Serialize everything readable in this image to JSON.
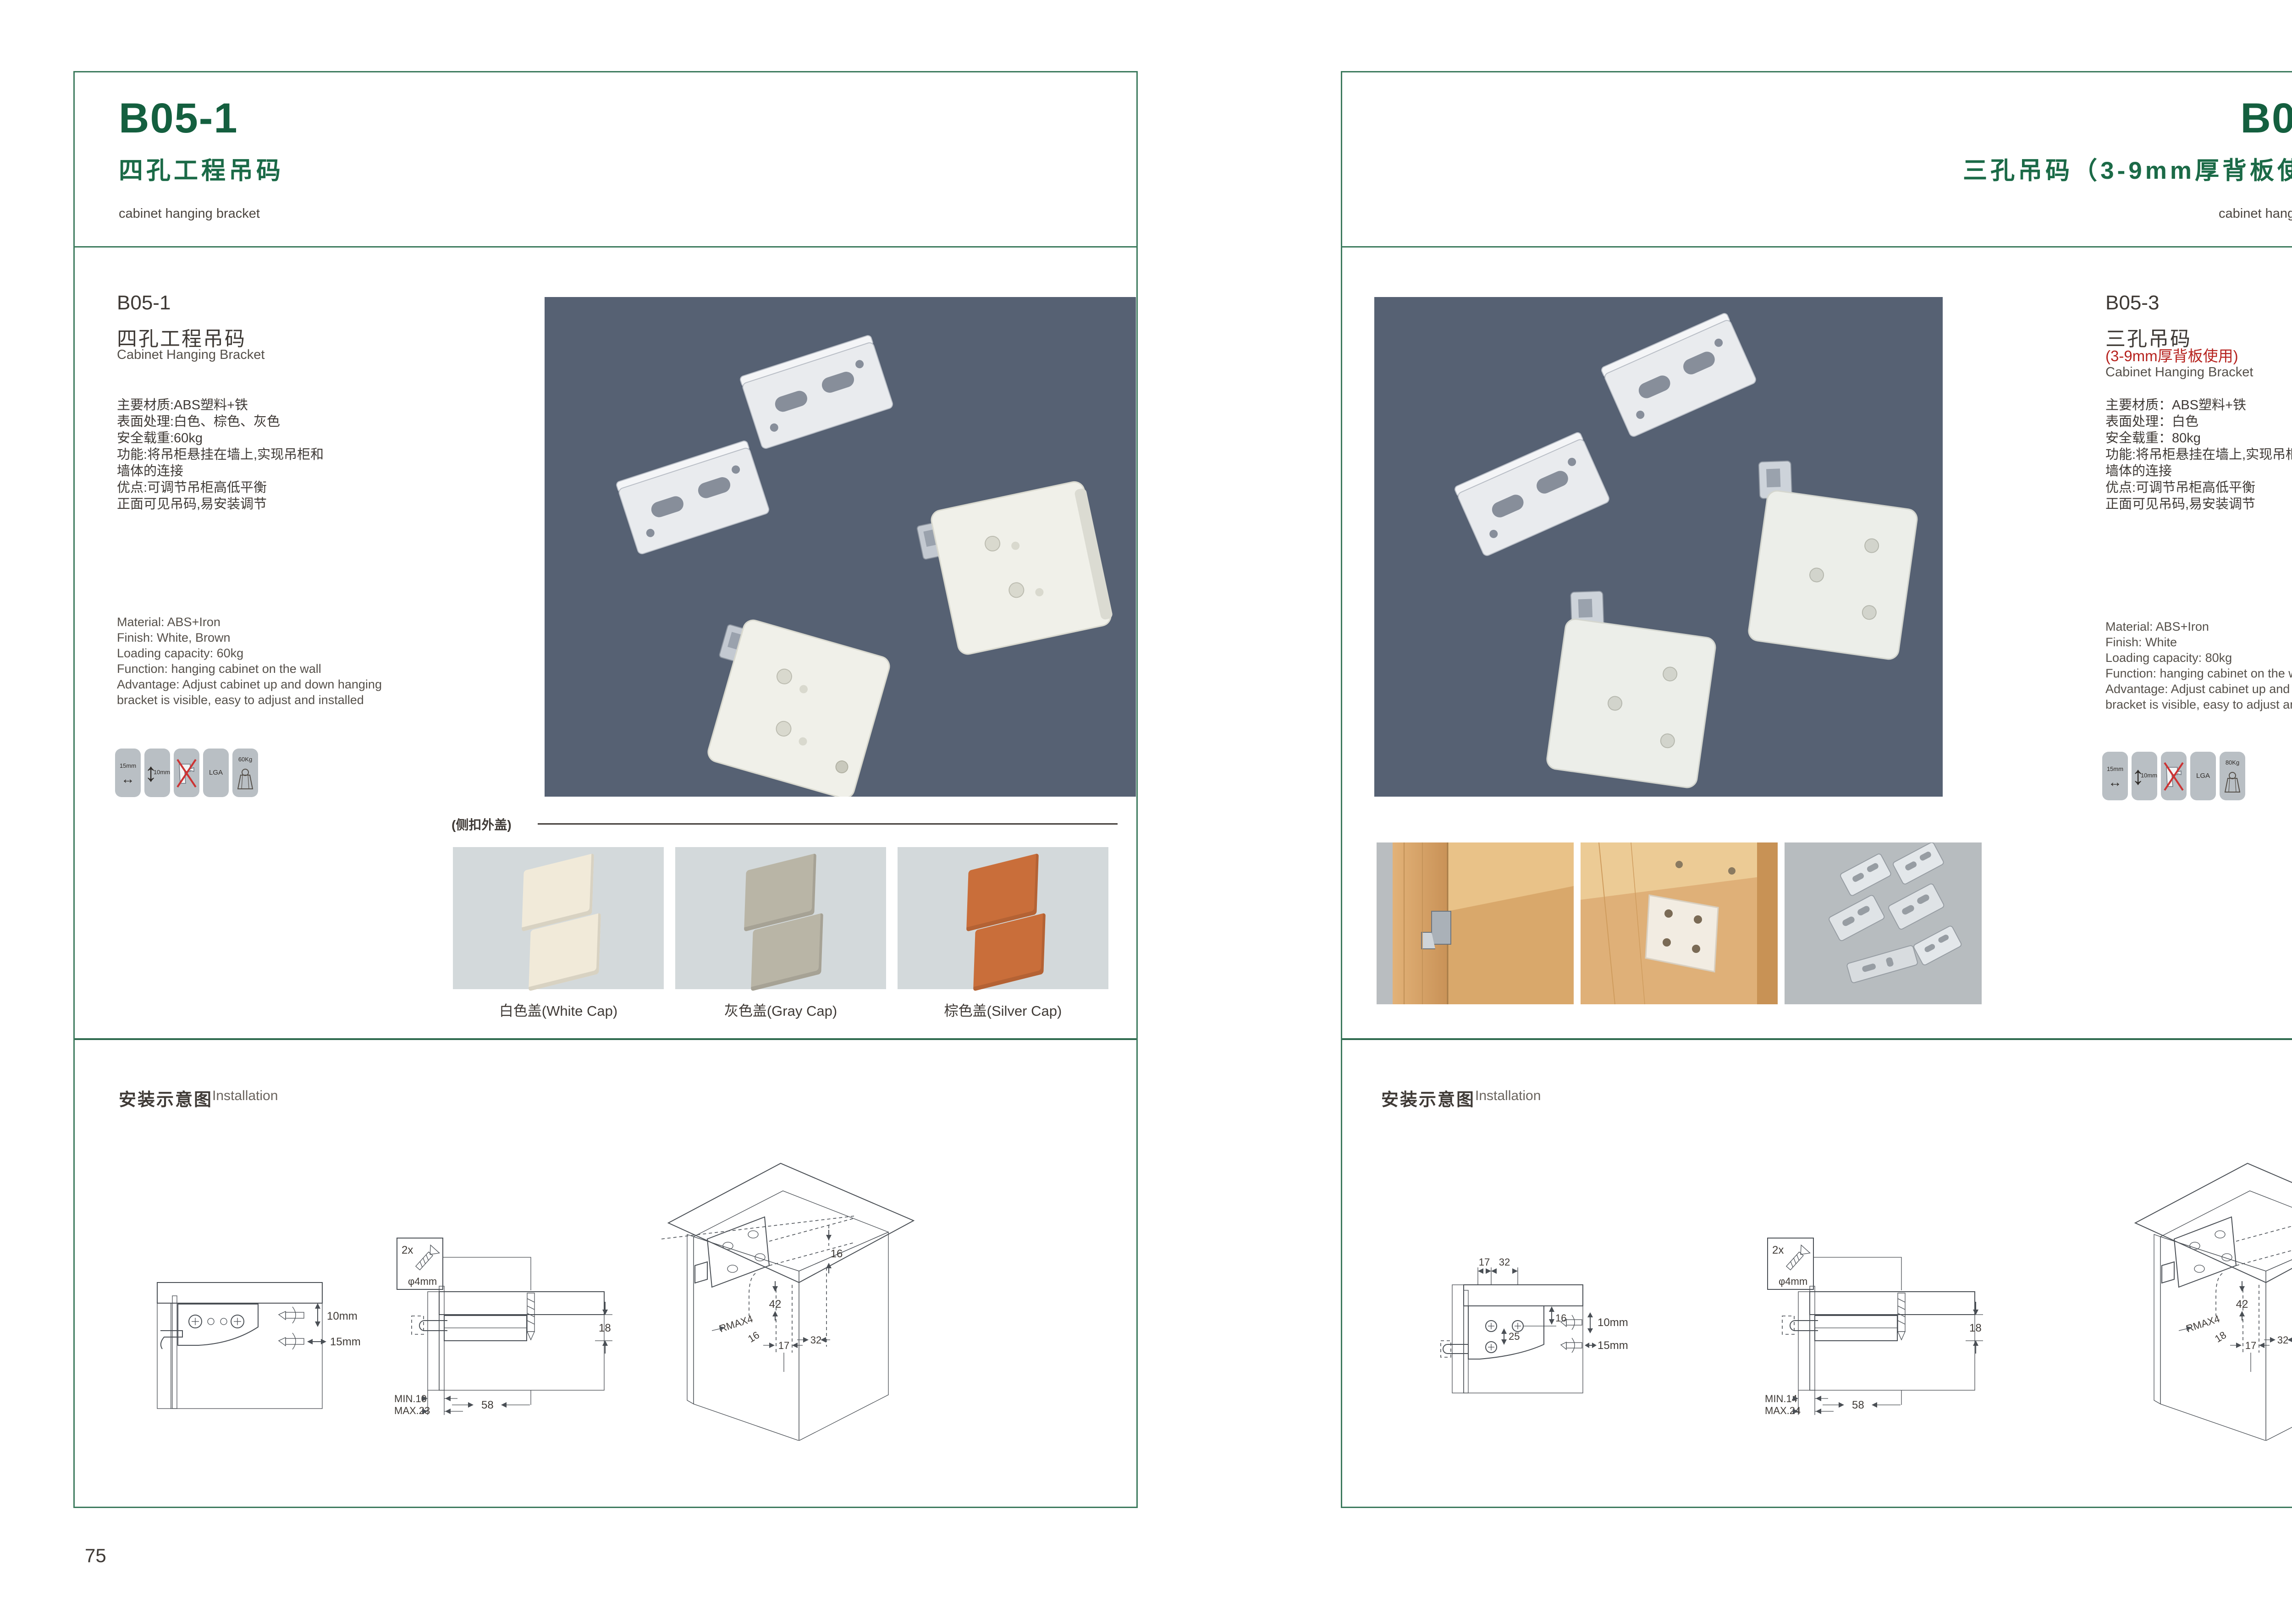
{
  "colors": {
    "frame_green": "#3c7a5d",
    "heading_green": "#145f3f",
    "accent_red": "#b6231f",
    "photo_background": "#566173",
    "cap_white": "#f1ead9",
    "cap_gray": "#b9b5a6",
    "cap_orange": "#c96e3a"
  },
  "page_left": {
    "header": {
      "code": "B05-1",
      "title_cn": "四孔工程吊码",
      "title_en": "cabinet hanging bracket"
    },
    "product": {
      "code": "B05-1",
      "name_cn": "四孔工程吊码",
      "name_en": "Cabinet Hanging Bracket",
      "specs_cn": [
        "主要材质:ABS塑料+铁",
        "表面处理:白色、棕色、灰色",
        "安全载重:60kg",
        "功能:将吊柜悬挂在墙上,实现吊柜和",
        "墙体的连接",
        "优点:可调节吊柜高低平衡",
        "正面可见吊码,易安装调节"
      ],
      "specs_en": [
        "Material: ABS+Iron",
        "Finish: White, Brown",
        "Loading capacity: 60kg",
        "Function: hanging cabinet on the wall",
        "Advantage: Adjust cabinet up and down hanging",
        "bracket is visible, easy to adjust and installed"
      ]
    },
    "icons": {
      "width_label": "15mm",
      "height_label": "10mm",
      "cert_label": "LGA",
      "load_label": "60Kg"
    },
    "caps": {
      "label": "(侧扣外盖)",
      "items": [
        {
          "caption": "白色盖(White Cap)",
          "color": "#f1ead9"
        },
        {
          "caption": "灰色盖(Gray Cap)",
          "color": "#b9b5a6"
        },
        {
          "caption": "棕色盖(Silver Cap)",
          "color": "#c96e3a"
        }
      ]
    },
    "installation": {
      "title_cn": "安装示意图",
      "title_en": "Installation",
      "d1": {
        "dim_v": "10mm",
        "dim_h": "15mm"
      },
      "d2": {
        "qty": "2x",
        "dia": "φ4mm",
        "h": "18",
        "min": "MIN.10",
        "max": "MAX.23",
        "depth": "58"
      },
      "d3": {
        "t": "16",
        "mid": "42",
        "r": "RMAX4",
        "b1": "16",
        "b2": "17",
        "b3": "32"
      }
    },
    "page_number": "75"
  },
  "page_right": {
    "header": {
      "code": "B05-3",
      "title_cn": "三孔吊码（3-9mm厚背板使用）",
      "title_en": "cabinet hanging bracket"
    },
    "product": {
      "code": "B05-3",
      "name_cn": "三孔吊码",
      "name_sub": "(3-9mm厚背板使用)",
      "name_en": "Cabinet Hanging Bracket",
      "specs_cn": [
        "主要材质：ABS塑料+铁",
        "表面处理：白色",
        "安全载重：80kg",
        "功能:将吊柜悬挂在墙上,实现吊柜和",
        "墙体的连接",
        "优点:可调节吊柜高低平衡",
        "正面可见吊码,易安装调节"
      ],
      "specs_en": [
        "Material: ABS+Iron",
        "Finish: White",
        "Loading capacity: 80kg",
        "Function: hanging cabinet on the wall",
        "Advantage: Adjust cabinet up and down hanging",
        "bracket is visible, easy to adjust and installed"
      ]
    },
    "icons": {
      "width_label": "15mm",
      "height_label": "10mm",
      "cert_label": "LGA",
      "load_label": "80Kg"
    },
    "installation": {
      "title_cn": "安装示意图",
      "title_en": "Installation",
      "d1": {
        "t1": "17",
        "t2": "32",
        "i1": "16",
        "i2": "25",
        "dim_v": "10mm",
        "dim_h": "15mm"
      },
      "d2": {
        "qty": "2x",
        "dia": "φ4mm",
        "h": "18",
        "min": "MIN.14",
        "max": "MAX.24",
        "depth": "58"
      },
      "d3": {
        "t": "16",
        "mid": "42",
        "r": "RMAX4",
        "b1": "18",
        "b2": "17",
        "b3": "32"
      }
    },
    "page_number": "76"
  }
}
